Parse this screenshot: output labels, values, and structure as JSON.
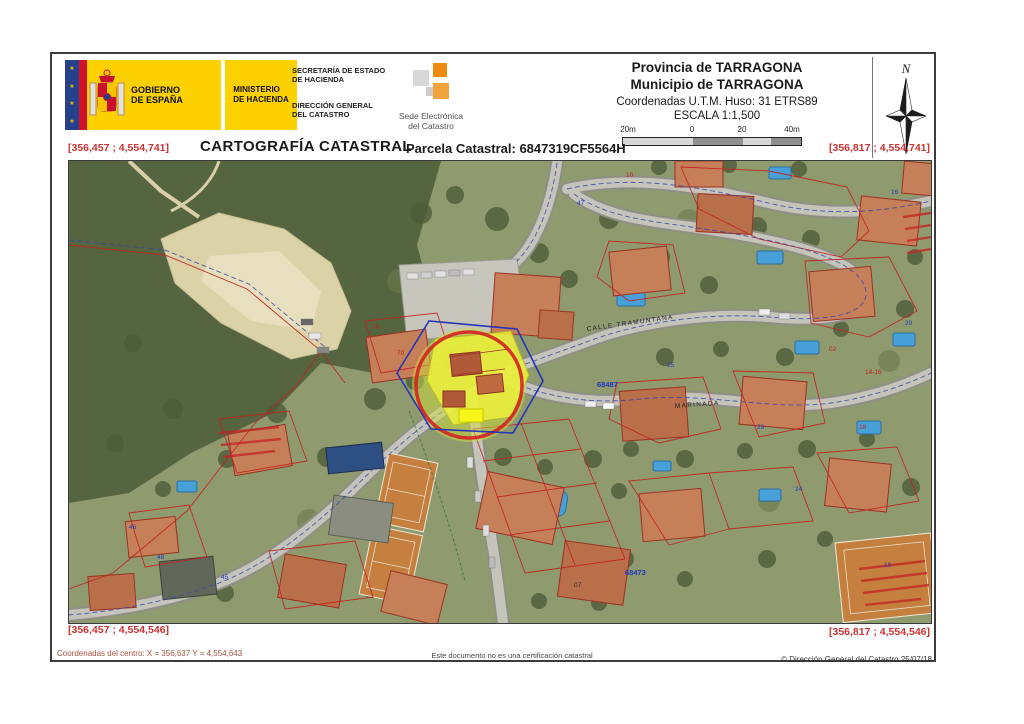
{
  "header": {
    "gobierno": "GOBIERNO\nDE ESPAÑA",
    "ministerio": "MINISTERIO\nDE HACIENDA",
    "secretaria": "SECRETARÍA DE ESTADO\nDE HACIENDA",
    "direccion": "DIRECCIÓN GENERAL\nDEL CATASTRO",
    "sede": "Sede Electrónica\ndel Catastro",
    "provincia": "Provincia de TARRAGONA",
    "municipio": "Municipio de TARRAGONA",
    "utm": "Coordenadas U.T.M. Huso: 31 ETRS89",
    "escala": "ESCALA 1:1,500",
    "scalebar_labels": [
      "20m",
      "0",
      "20",
      "40m"
    ],
    "north_label": "N"
  },
  "title_row": {
    "title": "CARTOGRAFÍA CATASTRAL",
    "parcela": "Parcela Catastral: 6847319CF5564H"
  },
  "map": {
    "corner_coords": {
      "top_left": "[356,457 ; 4,554,741]",
      "top_right": "[356,817 ; 4,554,741]",
      "bottom_left": "[356,457 ; 4,554,546]",
      "bottom_right": "[356,817 ; 4,554,546]"
    },
    "street_labels": [
      {
        "text": "CALLE TRAMUNTANA",
        "x": 518,
        "y": 170,
        "rot": -8
      },
      {
        "text": "MARINADA",
        "x": 606,
        "y": 247,
        "rot": -4
      }
    ],
    "block_labels": [
      {
        "text": "68487",
        "x": 528,
        "y": 226
      },
      {
        "text": "68473",
        "x": 556,
        "y": 414
      }
    ],
    "annotations": [
      {
        "text": "70",
        "x": 328,
        "y": 194,
        "color": "red"
      },
      {
        "text": "76",
        "x": 303,
        "y": 168,
        "color": "red"
      },
      {
        "text": "10",
        "x": 557,
        "y": 16,
        "color": "red"
      },
      {
        "text": "02",
        "x": 760,
        "y": 190,
        "color": "red"
      },
      {
        "text": "14-16",
        "x": 796,
        "y": 213,
        "color": "red"
      },
      {
        "text": "18",
        "x": 790,
        "y": 268,
        "color": "red"
      },
      {
        "text": "25",
        "x": 598,
        "y": 206,
        "color": "blue"
      },
      {
        "text": "16",
        "x": 822,
        "y": 33,
        "color": "blue"
      },
      {
        "text": "20",
        "x": 836,
        "y": 164,
        "color": "blue"
      },
      {
        "text": "47",
        "x": 508,
        "y": 44,
        "color": "blue"
      },
      {
        "text": "45",
        "x": 152,
        "y": 418,
        "color": "blue"
      },
      {
        "text": "46",
        "x": 60,
        "y": 368,
        "color": "blue"
      },
      {
        "text": "48",
        "x": 88,
        "y": 398,
        "color": "blue"
      },
      {
        "text": "23",
        "x": 688,
        "y": 268,
        "color": "blue"
      },
      {
        "text": "24",
        "x": 726,
        "y": 330,
        "color": "blue"
      },
      {
        "text": "10",
        "x": 815,
        "y": 406,
        "color": "blue"
      },
      {
        "text": "07",
        "x": 505,
        "y": 426,
        "color": "dark"
      }
    ],
    "colors": {
      "parcel_line_red": "#c42222",
      "road_line_blue": "#3a44b0",
      "highlight_yellow": "#eef23c",
      "highlight_ring_red": "#d42222"
    }
  },
  "footer": {
    "center_coords": "Coordenadas del centro: X = 356,637 Y = 4,554,643",
    "disclaimer": "Este documento no es una certificación catastral",
    "copyright": "© Dirección General del Catastro 25/07/18"
  }
}
